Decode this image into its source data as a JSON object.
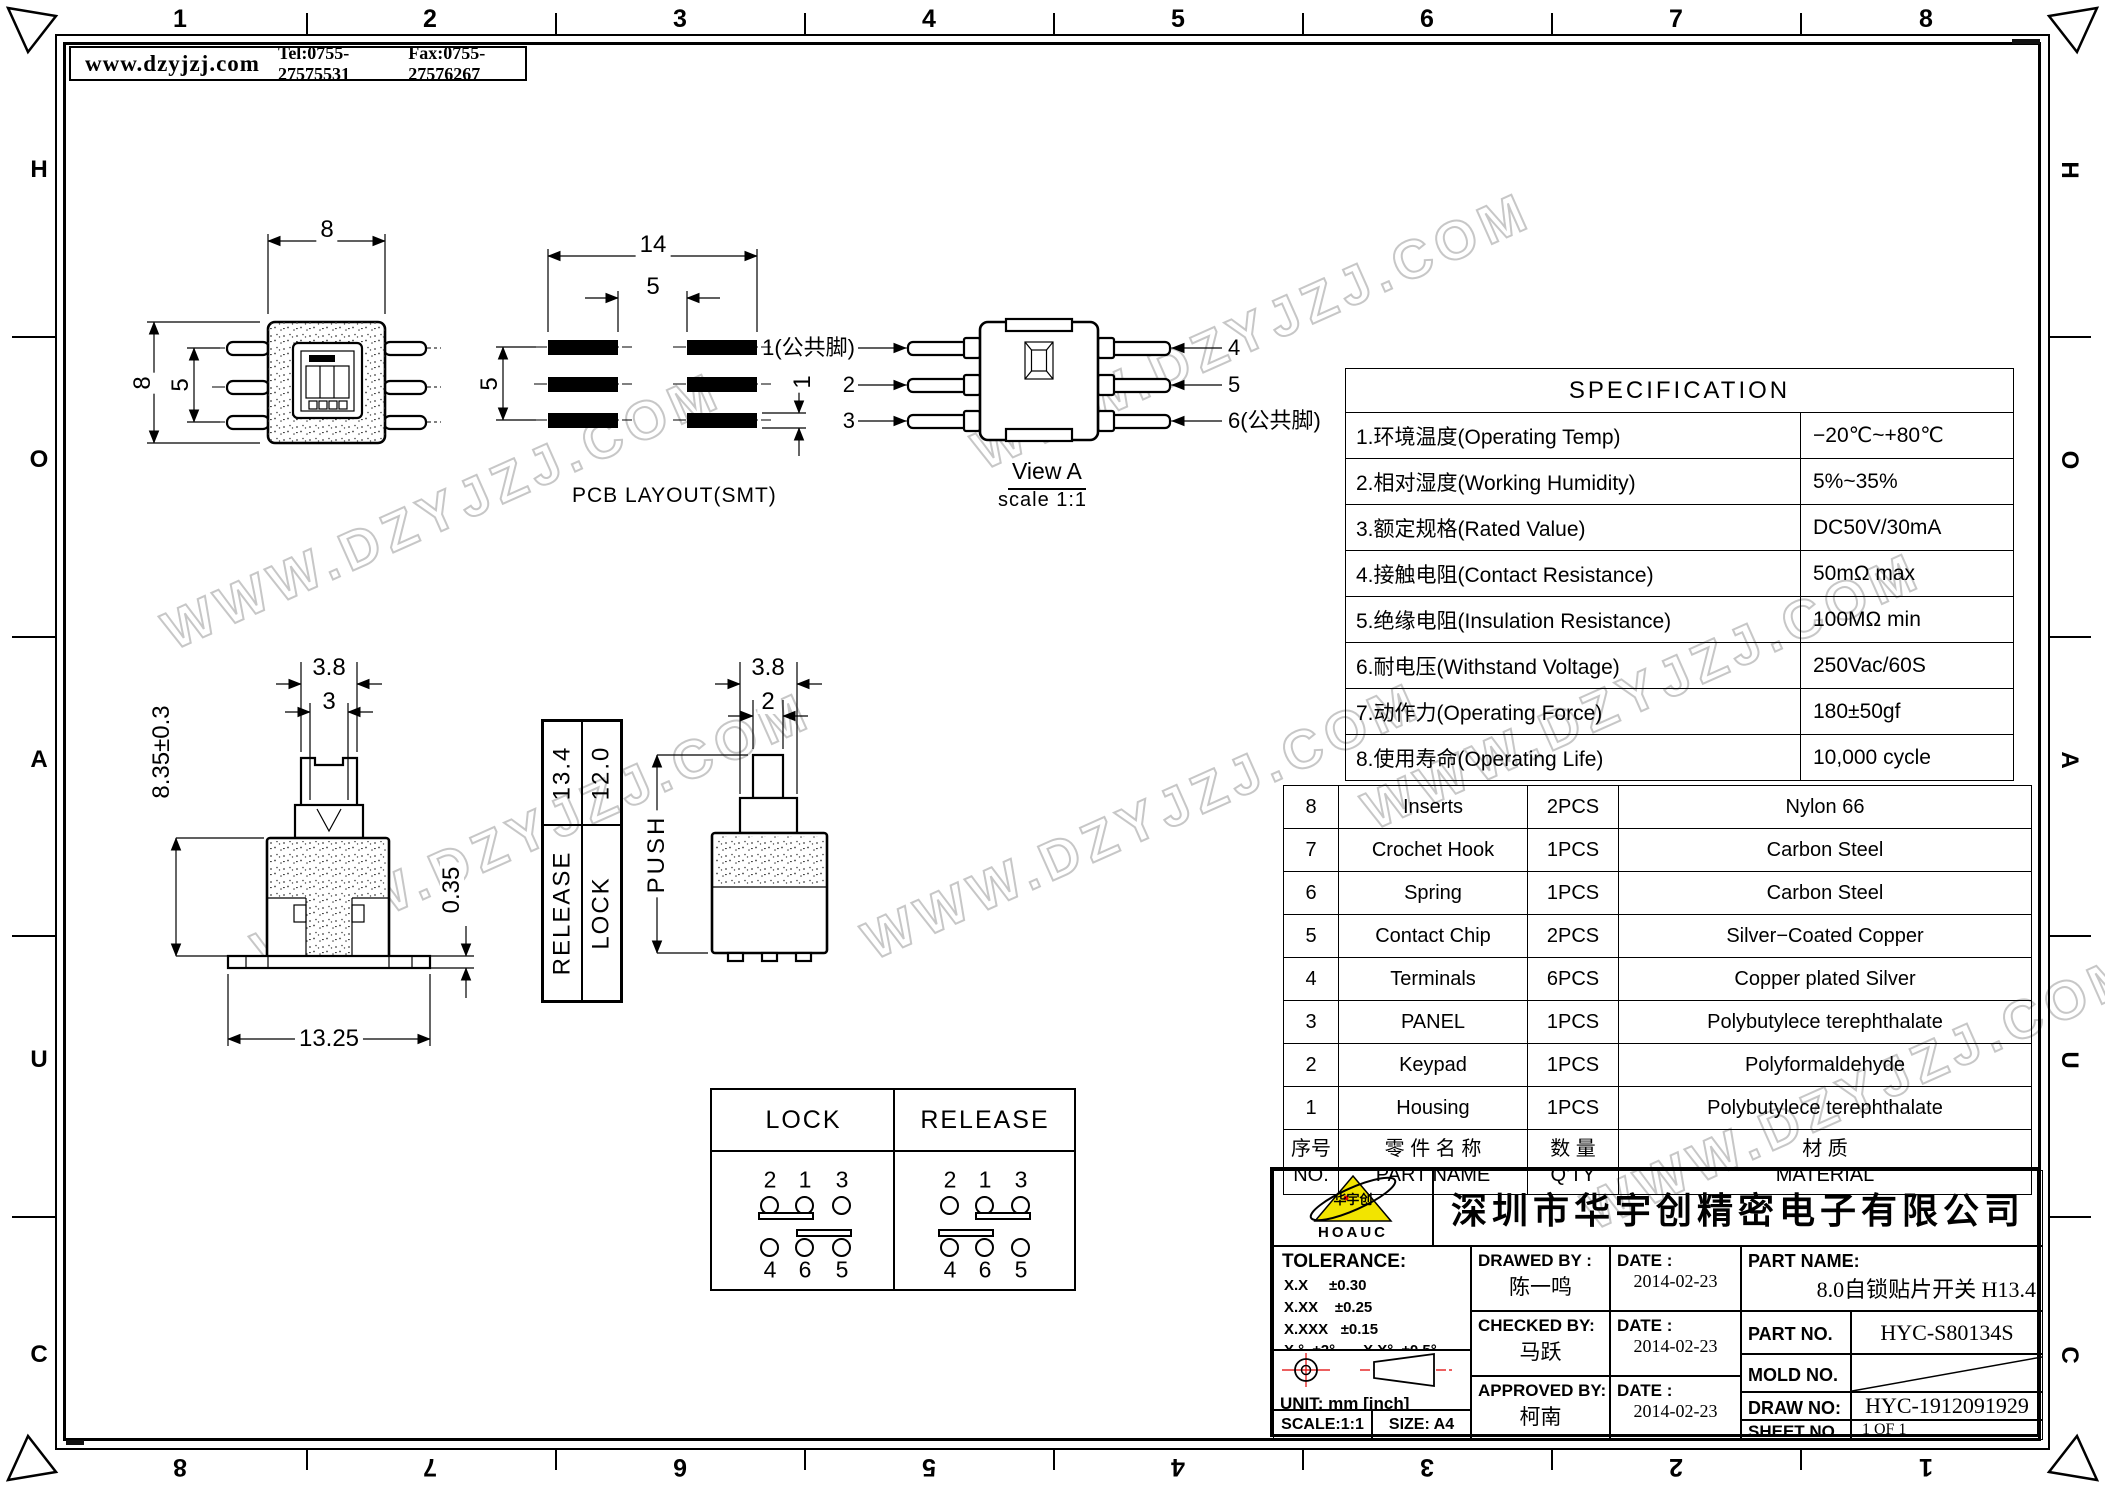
{
  "header": {
    "site": "www.dzyjzj.com",
    "tel": "Tel:0755-27575531",
    "fax": "Fax:0755-27576267"
  },
  "watermark": {
    "text": "WWW.DZYJZJ.COM"
  },
  "zones": {
    "top": [
      "1",
      "2",
      "3",
      "4",
      "5",
      "6",
      "7",
      "8"
    ],
    "bottom": [
      "8",
      "7",
      "6",
      "5",
      "4",
      "3",
      "2",
      "1"
    ],
    "side": [
      "H",
      "O",
      "A",
      "U",
      "C"
    ]
  },
  "drawings": {
    "top_view": {
      "dim_width": "8",
      "dim_height": "8",
      "dim_pin_pitch": "5"
    },
    "pcb": {
      "label": "PCB LAYOUT(SMT)",
      "dim_overall": "14",
      "dim_gap": "5",
      "dim_pitch": "5",
      "dim_pad": "1"
    },
    "view_a": {
      "title": "View A",
      "scale": "scale 1:1",
      "pin1": "1(公共脚)",
      "pin2": "2",
      "pin3": "3",
      "pin4": "4",
      "pin5": "5",
      "pin6": "6(公共脚)"
    },
    "front": {
      "dim_cap": "3.8",
      "dim_stem": "3",
      "dim_height": "8.35±0.3",
      "dim_foot": "0.35",
      "dim_base": "13.25"
    },
    "stroke": {
      "release_label": "RELEASE",
      "release_value": "13.4",
      "lock_label": "LOCK",
      "lock_value": "12.0"
    },
    "side": {
      "dim_cap": "3.8",
      "dim_stem": "2",
      "push": "PUSH"
    }
  },
  "circuit": {
    "lock": {
      "title": "LOCK",
      "top": [
        "2",
        "1",
        "3"
      ],
      "bottom": [
        "4",
        "6",
        "5"
      ]
    },
    "release": {
      "title": "RELEASE",
      "top": [
        "2",
        "1",
        "3"
      ],
      "bottom": [
        "4",
        "6",
        "5"
      ]
    }
  },
  "spec": {
    "title": "SPECIFICATION",
    "rows": [
      {
        "item": "1.环境温度(Operating Temp)",
        "value": "−20℃~+80℃"
      },
      {
        "item": "2.相对湿度(Working Humidity)",
        "value": "5%~35%"
      },
      {
        "item": "3.额定规格(Rated Value)",
        "value": "DC50V/30mA"
      },
      {
        "item": "4.接触电阻(Contact Resistance)",
        "value": "50mΩ max"
      },
      {
        "item": "5.绝缘电阻(Insulation Resistance)",
        "value": "100MΩ min"
      },
      {
        "item": "6.耐电压(Withstand Voltage)",
        "value": "250Vac/60S"
      },
      {
        "item": "7.动作力(Operating Force)",
        "value": "180±50gf"
      },
      {
        "item": "8.使用寿命(Operating Life)",
        "value": "10,000 cycle"
      }
    ]
  },
  "parts": {
    "header": {
      "no_cn": "序号",
      "no_en": "NO.",
      "name_cn": "零 件 名 称",
      "name_en": "PART NAME",
      "qty_cn": "数 量",
      "qty_en": "Q'TY",
      "mat_cn": "材 质",
      "mat_en": "MATERIAL"
    },
    "rows": [
      {
        "no": "8",
        "name": "Inserts",
        "qty": "2PCS",
        "material": "Nylon 66"
      },
      {
        "no": "7",
        "name": "Crochet Hook",
        "qty": "1PCS",
        "material": "Carbon Steel"
      },
      {
        "no": "6",
        "name": "Spring",
        "qty": "1PCS",
        "material": "Carbon Steel"
      },
      {
        "no": "5",
        "name": "Contact Chip",
        "qty": "2PCS",
        "material": "Silver−Coated Copper"
      },
      {
        "no": "4",
        "name": "Terminals",
        "qty": "6PCS",
        "material": "Copper plated Silver"
      },
      {
        "no": "3",
        "name": "PANEL",
        "qty": "1PCS",
        "material": "Polybutylece terephthalate"
      },
      {
        "no": "2",
        "name": "Keypad",
        "qty": "1PCS",
        "material": "Polyformaldehyde"
      },
      {
        "no": "1",
        "name": "Housing",
        "qty": "1PCS",
        "material": "Polybutylece terephthalate"
      }
    ]
  },
  "title_block": {
    "company": "深圳市华宇创精密电子有限公司",
    "logo": {
      "text": "HOAUC",
      "mark": "华宇创"
    },
    "tolerance": {
      "title": "TOLERANCE:",
      "l1": "X.X     ±0.30",
      "l2": "X.XX    ±0.25",
      "l3": "X.XXX   ±0.15",
      "l4": "X.°  ±2°",
      "l5": "X.X°  ±0.5°"
    },
    "unit": "UNIT:  mm  [inch]",
    "scale": "SCALE:1:1",
    "size": "SIZE:  A4",
    "drawed": {
      "label": "DRAWED BY :",
      "name": "陈一鸣",
      "date_label": "DATE :",
      "date": "2014-02-23"
    },
    "checked": {
      "label": "CHECKED BY:",
      "name": "马跃",
      "date_label": "DATE :",
      "date": "2014-02-23"
    },
    "approved": {
      "label": "APPROVED BY:",
      "name": "柯南",
      "date_label": "DATE :",
      "date": "2014-02-23"
    },
    "part_name": {
      "label": "PART NAME:",
      "value": "8.0自锁贴片开关 H13.4"
    },
    "part_no": {
      "label": "PART NO.",
      "value": "HYC-S80134S"
    },
    "mold_no": {
      "label": "MOLD NO.",
      "value": ""
    },
    "draw_no": {
      "label": "DRAW NO:",
      "value": "HYC-1912091929"
    },
    "sheet_no": {
      "label": "SHEET NO.",
      "value": "1 OF 1"
    }
  }
}
